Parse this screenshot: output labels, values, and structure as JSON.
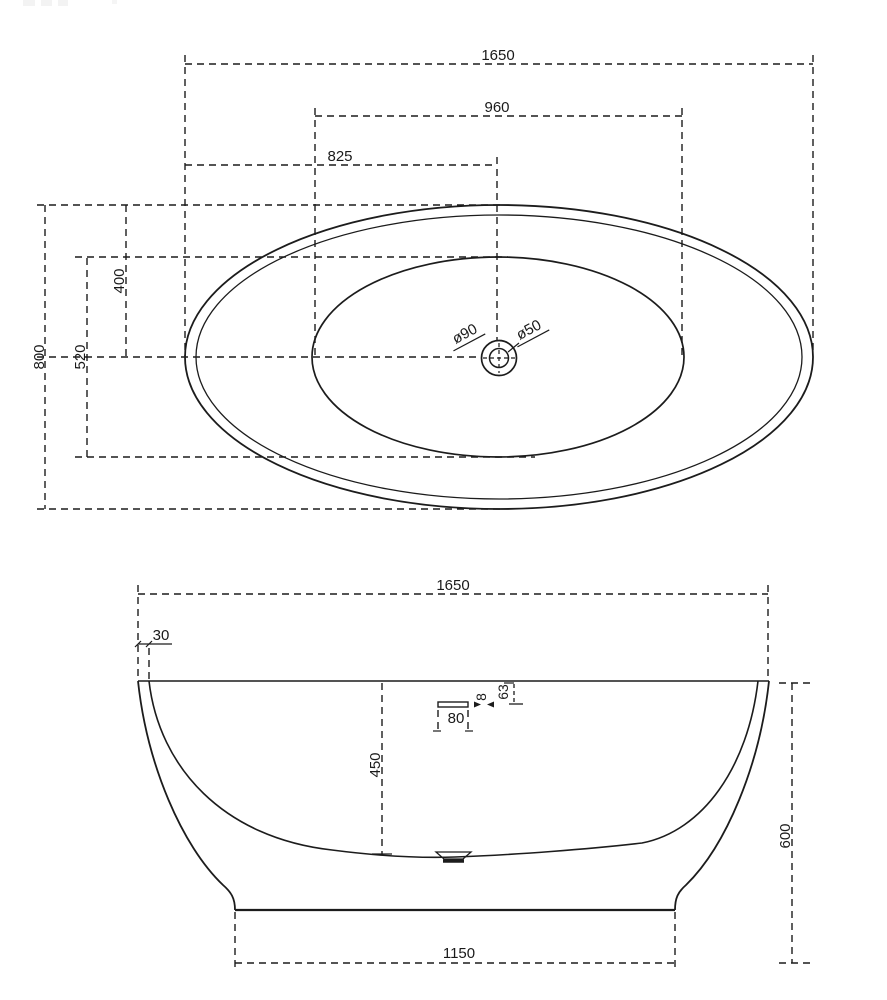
{
  "views": {
    "top": {
      "label_length": "1650",
      "label_inner_length": "960",
      "label_center_length": "825",
      "label_width": "800",
      "label_inner_width": "520",
      "label_half_width": "400",
      "label_drain_outer": "ø90",
      "label_drain_inner": "ø50"
    },
    "side": {
      "label_length": "1650",
      "label_rim_offset": "30",
      "label_depth": "450",
      "label_overflow_width": "80",
      "label_overflow_height": "8",
      "label_overflow_offset": "63",
      "label_height": "600",
      "label_base_width": "1150"
    }
  },
  "colors": {
    "line": "#1c1c1c",
    "text": "#1a1a1a",
    "background": "#ffffff"
  }
}
